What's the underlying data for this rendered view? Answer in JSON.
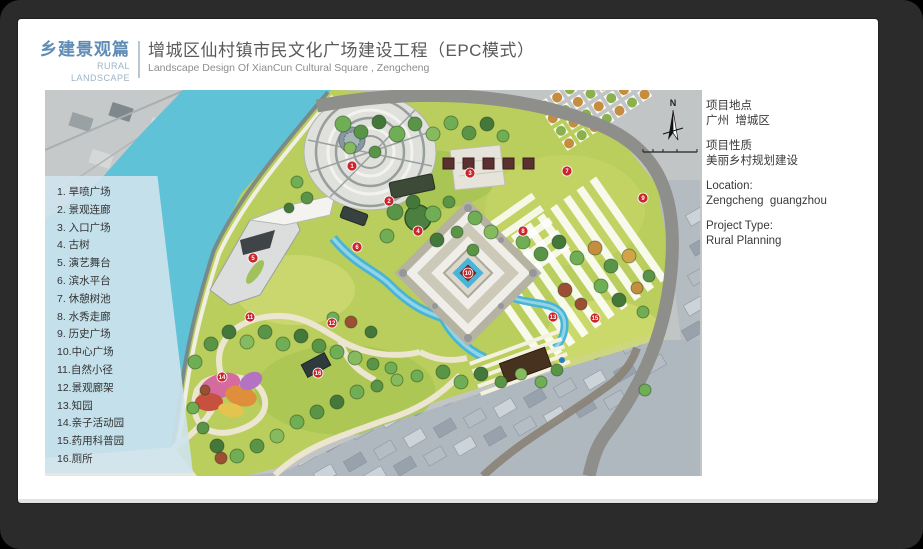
{
  "header": {
    "section_title_cn": "乡建景观篇",
    "section_title_en": "RURAL LANDSCAPE",
    "project_title_cn": "增城区仙村镇市民文化广场建设工程（EPC模式）",
    "project_title_en": "Landscape Design Of XianCun Cultural Square , Zengcheng",
    "accent_color": "#5e8cb4"
  },
  "legend": {
    "items": [
      "1. 旱喷广场",
      "2. 景观连廊",
      "3. 入口广场",
      "4. 古树",
      "5. 演艺舞台",
      "6. 滨水平台",
      "7. 休憩树池",
      "8. 水秀走廊",
      "9. 历史广场",
      "10.中心广场",
      "11.自然小径",
      "12.景观廊架",
      "13.知园",
      "14.亲子活动园",
      "15.药用科普园",
      "16.厕所"
    ]
  },
  "info_panel": {
    "location_label_cn": "项目地点",
    "location_value_cn": "广州  增城区",
    "type_label_cn": "项目性质",
    "type_value_cn": "美丽乡村规划建设",
    "location_label_en": "Location:",
    "location_value_en": "Zengcheng  guangzhou",
    "type_label_en": "Project Type:",
    "type_value_en": "Rural Planning"
  },
  "map": {
    "compass_label": "N",
    "colors": {
      "water": "#5fc2d6",
      "marker": "#c9252b",
      "road": "#8e8e8b",
      "lawn": "#b9ce5c"
    },
    "markers": [
      {
        "n": 1,
        "x": 307,
        "y": 76,
        "label": "旱喷广场"
      },
      {
        "n": 2,
        "x": 344,
        "y": 111,
        "label": "景观连廊"
      },
      {
        "n": 3,
        "x": 425,
        "y": 83,
        "label": "入口广场"
      },
      {
        "n": 4,
        "x": 373,
        "y": 141,
        "label": "古树"
      },
      {
        "n": 5,
        "x": 208,
        "y": 168,
        "label": "演艺舞台"
      },
      {
        "n": 6,
        "x": 312,
        "y": 157,
        "label": "滨水平台"
      },
      {
        "n": 7,
        "x": 522,
        "y": 81,
        "label": "休憩树池"
      },
      {
        "n": 8,
        "x": 478,
        "y": 141,
        "label": "水秀走廊"
      },
      {
        "n": 9,
        "x": 598,
        "y": 108,
        "label": "历史广场"
      },
      {
        "n": 10,
        "x": 423,
        "y": 183,
        "label": "中心广场"
      },
      {
        "n": 11,
        "x": 205,
        "y": 227,
        "label": "自然小径"
      },
      {
        "n": 12,
        "x": 287,
        "y": 233,
        "label": "景观廊架"
      },
      {
        "n": 13,
        "x": 508,
        "y": 227,
        "label": "知园"
      },
      {
        "n": 14,
        "x": 177,
        "y": 287,
        "label": "亲子活动园"
      },
      {
        "n": 15,
        "x": 550,
        "y": 228,
        "label": "药用科普园"
      },
      {
        "n": 16,
        "x": 273,
        "y": 283,
        "label": "厕所"
      }
    ]
  }
}
